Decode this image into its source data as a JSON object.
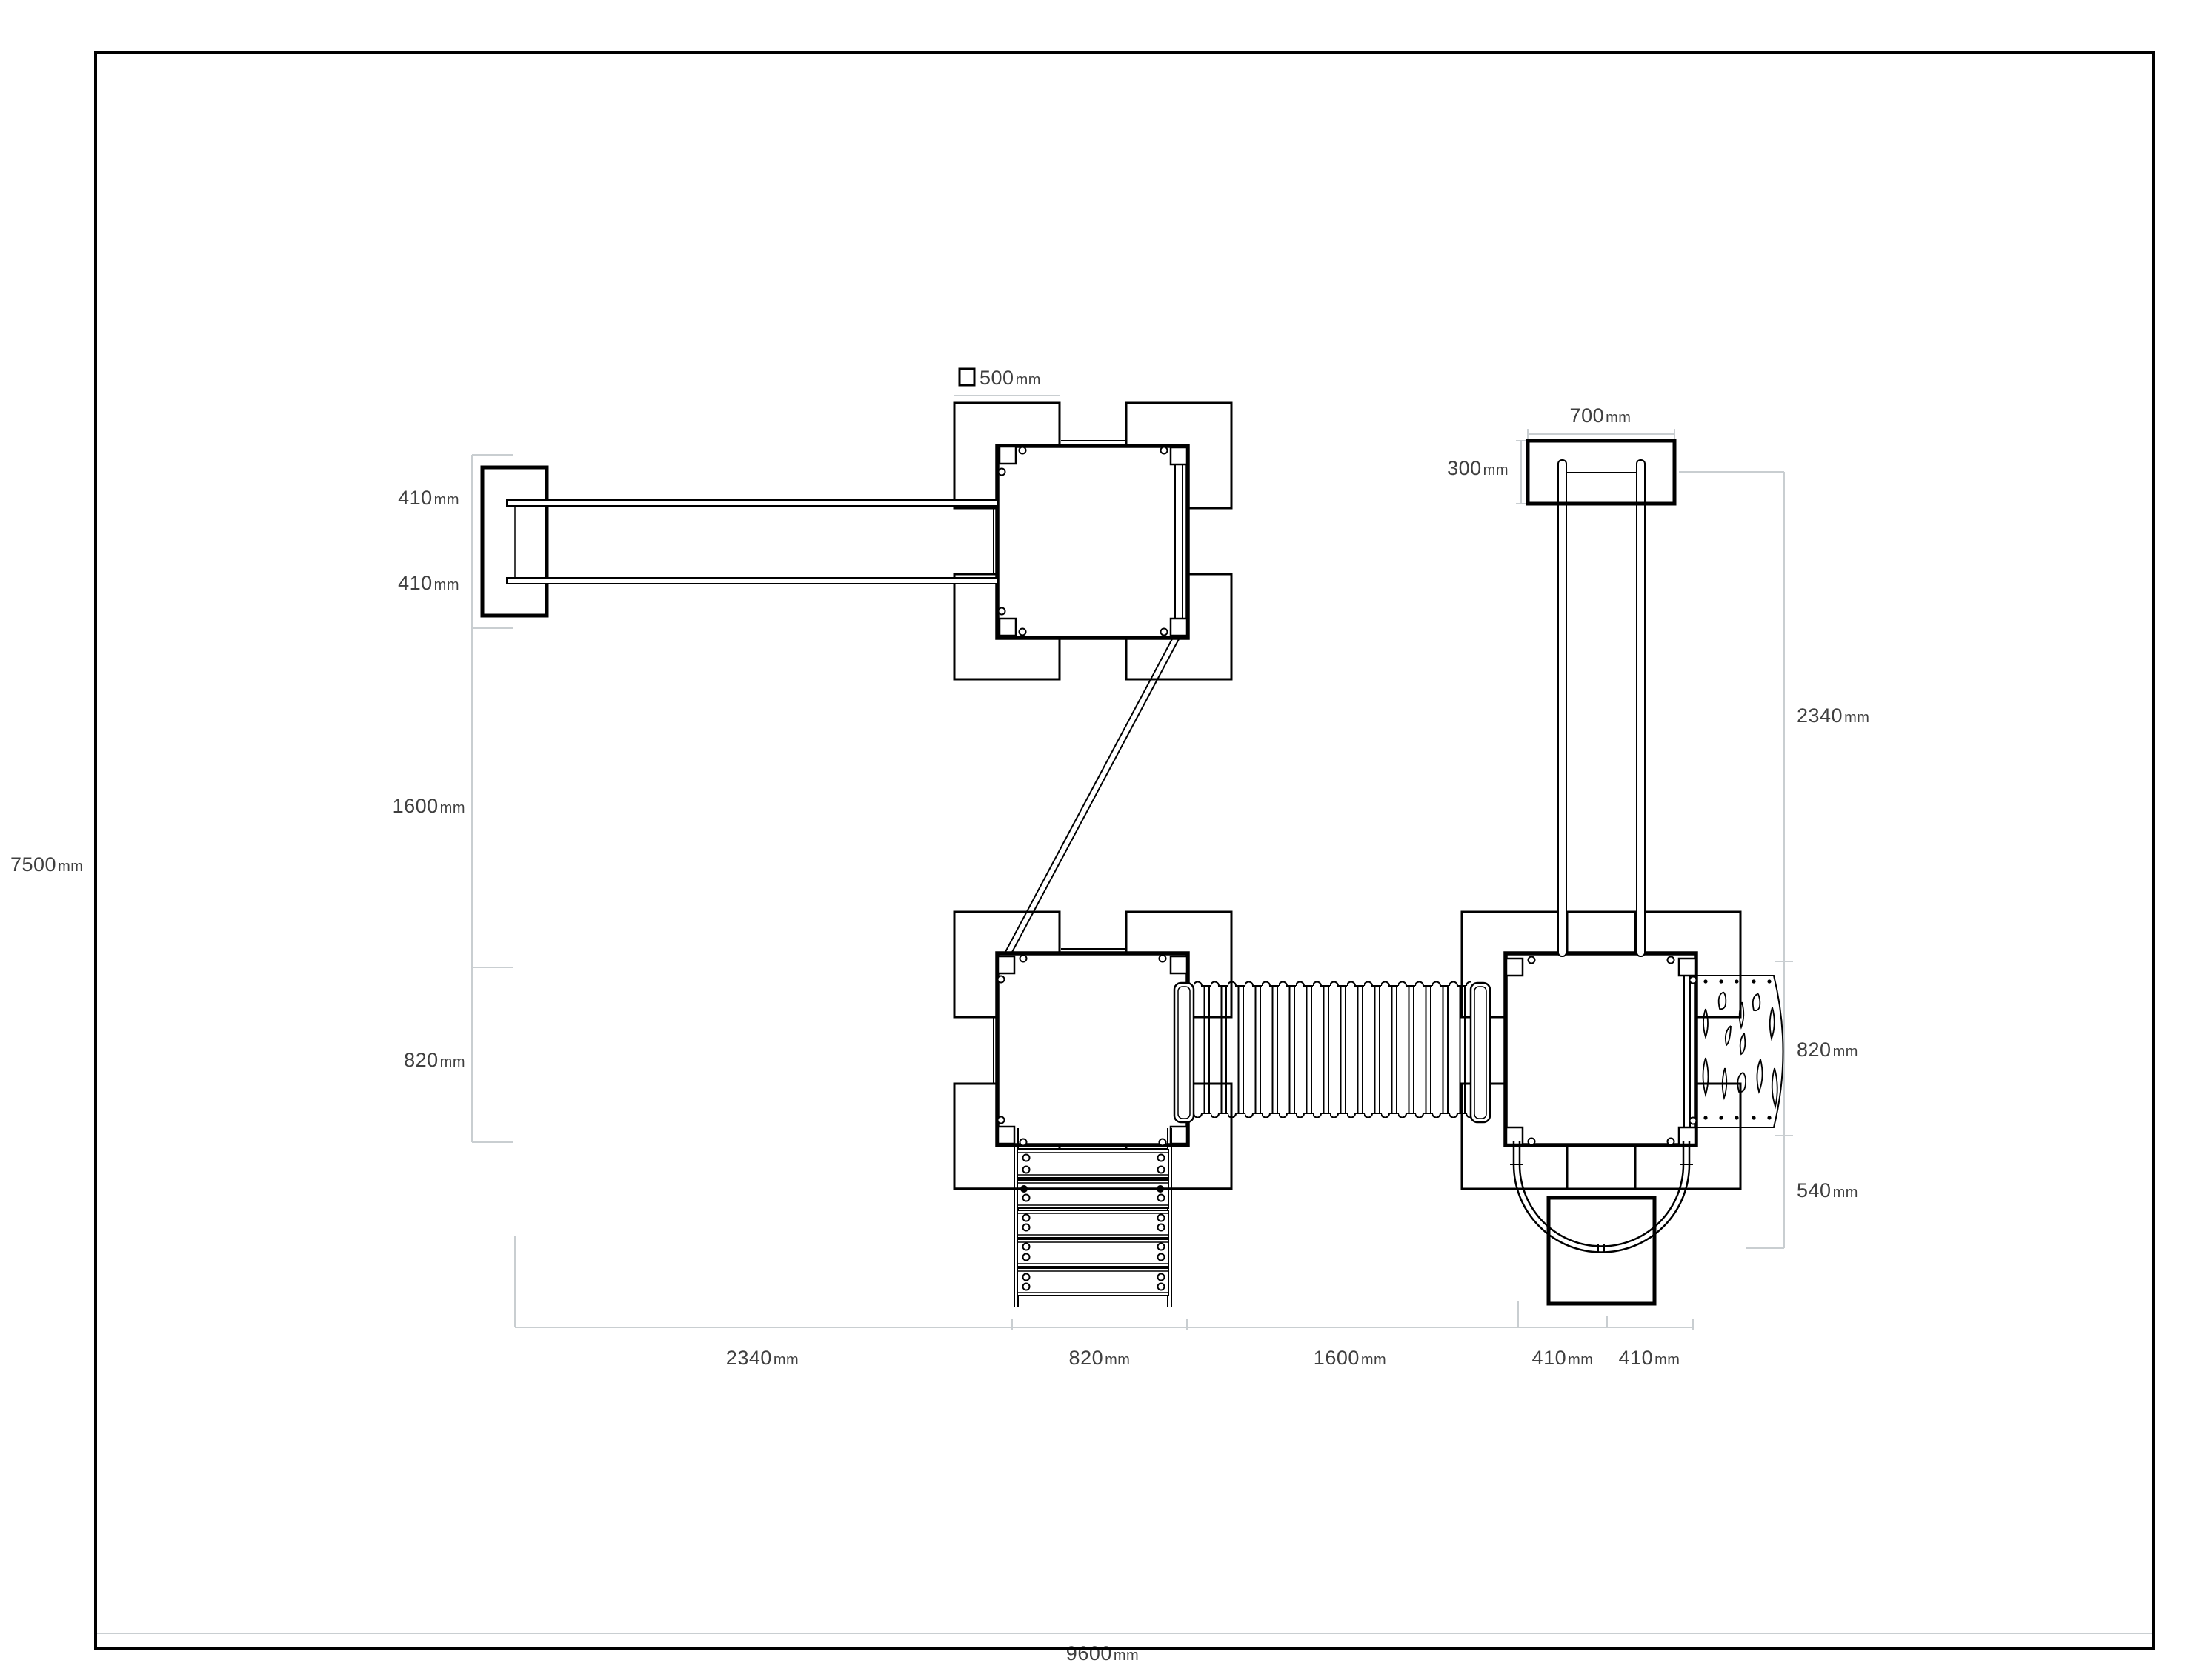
{
  "legend": {
    "symbol": "square-icon",
    "value": "500",
    "unit": "mm"
  },
  "dimensions": {
    "left": [
      {
        "value": "410",
        "unit": "mm"
      },
      {
        "value": "410",
        "unit": "mm"
      },
      {
        "value": "1600",
        "unit": "mm"
      },
      {
        "value": "820",
        "unit": "mm"
      }
    ],
    "right_top": [
      {
        "value": "700",
        "unit": "mm"
      },
      {
        "value": "300",
        "unit": "mm"
      }
    ],
    "right": [
      {
        "value": "2340",
        "unit": "mm"
      },
      {
        "value": "820",
        "unit": "mm"
      },
      {
        "value": "540",
        "unit": "mm"
      }
    ],
    "bottom": [
      {
        "value": "2340",
        "unit": "mm"
      },
      {
        "value": "820",
        "unit": "mm"
      },
      {
        "value": "1600",
        "unit": "mm"
      },
      {
        "value": "410",
        "unit": "mm"
      },
      {
        "value": "410",
        "unit": "mm"
      }
    ],
    "overall_height": {
      "value": "7500",
      "unit": "mm"
    },
    "overall_width": {
      "value": "9600",
      "unit": "mm"
    }
  },
  "colors": {
    "line": "#000000",
    "dimension_line": "#c9ced1",
    "label_text": "#3f3f3f",
    "background": "#ffffff"
  }
}
